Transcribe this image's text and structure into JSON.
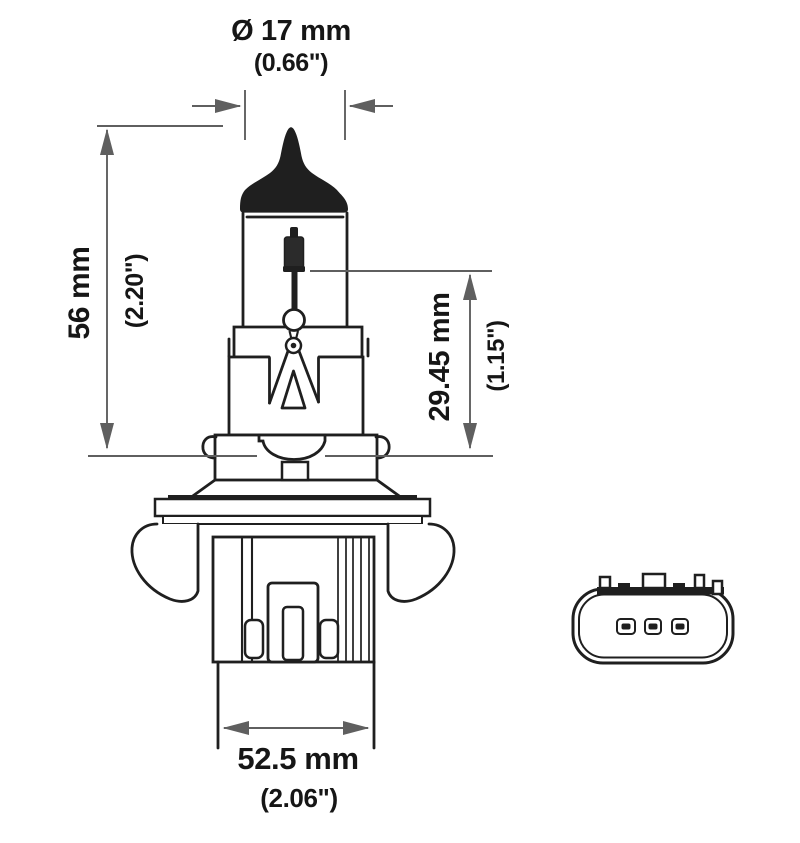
{
  "page": {
    "width": 800,
    "height": 843,
    "background": "#ffffff"
  },
  "colors": {
    "background": "#ffffff",
    "ink": "#1f1f1f",
    "dimension": "#5f5f5f",
    "label": "#161616"
  },
  "drawing": {
    "subject": "Halogen headlight bulb technical line drawing, side elevation with 3-pin connector face view",
    "views": [
      "bulb-side-view",
      "connector-face-view"
    ],
    "connector": {
      "pin_count": 3
    }
  },
  "labels": {
    "diameter_mm": "Ø 17 mm",
    "diameter_in": "(0.66\")",
    "overall_mm": "56 mm",
    "overall_in": "(2.20\")",
    "bulb_mm": "29.45 mm",
    "bulb_in": "(1.15\")",
    "width_mm": "52.5 mm",
    "width_in": "(2.06\")"
  },
  "dimensions": [
    {
      "feature": "glass envelope diameter",
      "mm": 17,
      "inches": 0.66
    },
    {
      "feature": "length tip to seating plane",
      "mm": 56,
      "inches": 2.2
    },
    {
      "feature": "filament to seating plane",
      "mm": 29.45,
      "inches": 1.15
    },
    {
      "feature": "base width",
      "mm": 52.5,
      "inches": 2.06
    }
  ]
}
